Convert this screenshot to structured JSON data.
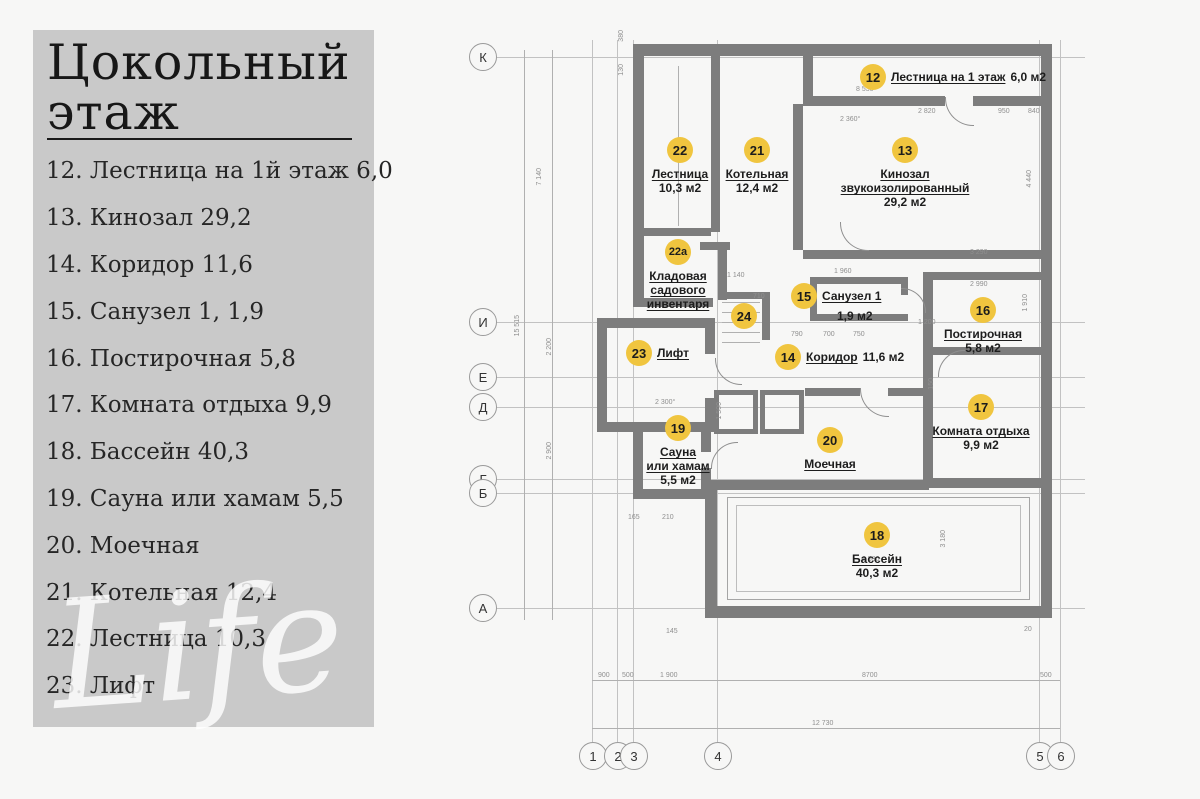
{
  "page": {
    "background": "#f7f7f6",
    "panel_color": "#c9c9c9"
  },
  "sidebar": {
    "title": "Цокольный этаж",
    "items": [
      "12. Лестница на 1й этаж 6,0",
      "13. Кинозал 29,2",
      "14. Коридор 11,6",
      "15. Санузел 1, 1,9",
      "16. Постирочная 5,8",
      "17. Комната отдыха 9,9",
      "18. Бассейн 40,3",
      "19. Сауна или хамам 5,5",
      "20. Моечная",
      "21. Котельная 12,4",
      "22. Лестница 10,3",
      "23. Лифт"
    ]
  },
  "watermark": "Life",
  "plan": {
    "marker_color": "#f0c53f",
    "wall_color": "#7d7d7d",
    "rooms": [
      {
        "num": "12",
        "name": "Лестница на 1 этаж",
        "area": "6,0 м2"
      },
      {
        "num": "13",
        "name": "Кинозал\nзвукоизолированный",
        "area": "29,2 м2"
      },
      {
        "num": "14",
        "name": "Коридор",
        "area": "11,6 м2"
      },
      {
        "num": "15",
        "name": "Санузел 1",
        "area": "1,9 м2"
      },
      {
        "num": "16",
        "name": "Постирочная",
        "area": "5,8 м2"
      },
      {
        "num": "17",
        "name": "Комната отдыха",
        "area": "9,9 м2"
      },
      {
        "num": "18",
        "name": "Бассейн",
        "area": "40,3 м2"
      },
      {
        "num": "19",
        "name": "Сауна\nили хамам",
        "area": "5,5 м2"
      },
      {
        "num": "20",
        "name": "Моечная",
        "area": ""
      },
      {
        "num": "21",
        "name": "Котельная",
        "area": "12,4 м2"
      },
      {
        "num": "22",
        "name": "Лестница",
        "area": "10,3 м2"
      },
      {
        "num": "22а",
        "name": "Кладовая\nсадового\nинвентаря",
        "area": ""
      },
      {
        "num": "23",
        "name": "Лифт",
        "area": ""
      },
      {
        "num": "24",
        "name": "",
        "area": ""
      }
    ],
    "row_axes": [
      "К",
      "И",
      "Е",
      "Д",
      "Г",
      "Б",
      "А"
    ],
    "col_axes": [
      "1",
      "2",
      "3",
      "4",
      "5",
      "6"
    ],
    "dims": [
      "7 140",
      "15 515",
      "2 200",
      "2 900",
      "380",
      "130",
      "2 360°",
      "2 820",
      "950",
      "840",
      "4 440",
      "3 290",
      "2 990",
      "1 960",
      "1 140",
      "710",
      "790",
      "700",
      "750",
      "1 200",
      "150",
      "1 500",
      "2 300°",
      "165",
      "210",
      "145",
      "20",
      "900",
      "500",
      "1 900",
      "8700",
      "500",
      "12 730",
      "8 530",
      "8 530",
      "3 180",
      "1 910"
    ]
  }
}
